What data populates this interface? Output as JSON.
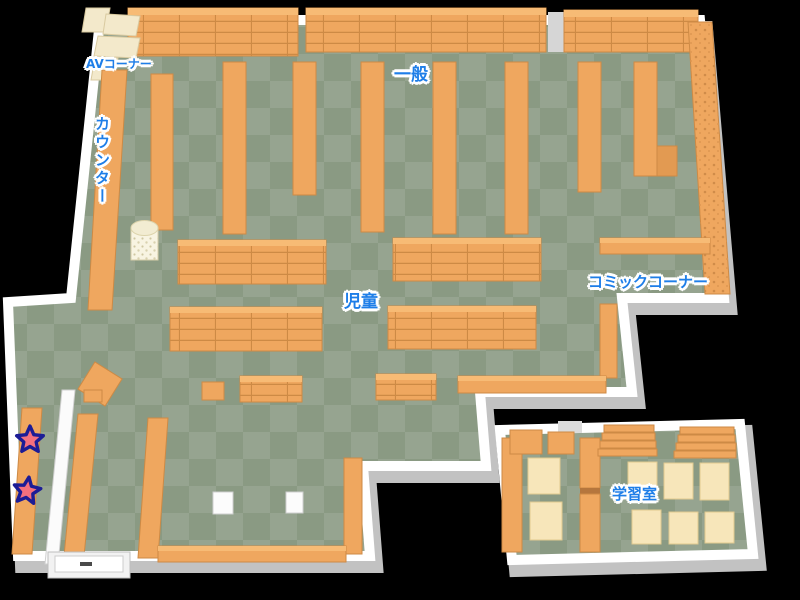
{
  "map": {
    "areas": {
      "av_corner": "AVコーナー",
      "counter": "カウンター",
      "general": "一般",
      "children": "児童",
      "comic_corner": "コミックコーナー",
      "study_room": "学習室"
    },
    "markers": {
      "star_count": 2
    },
    "colors": {
      "background": "#000000",
      "floor_light": "#96a490",
      "floor_dark": "#8a9a83",
      "wall": "#ffffff",
      "wall_shadow": "#c2c2c2",
      "shelf": "#efa75f",
      "shelf_line": "#cd8a45",
      "shelf_highlight": "#f7bb75",
      "desk": "#f7e6ba",
      "label_text": "#1e7ee8",
      "label_outline": "#ffffff",
      "star_fill": "#f4707e",
      "star_outline": "#1c1c96"
    }
  }
}
